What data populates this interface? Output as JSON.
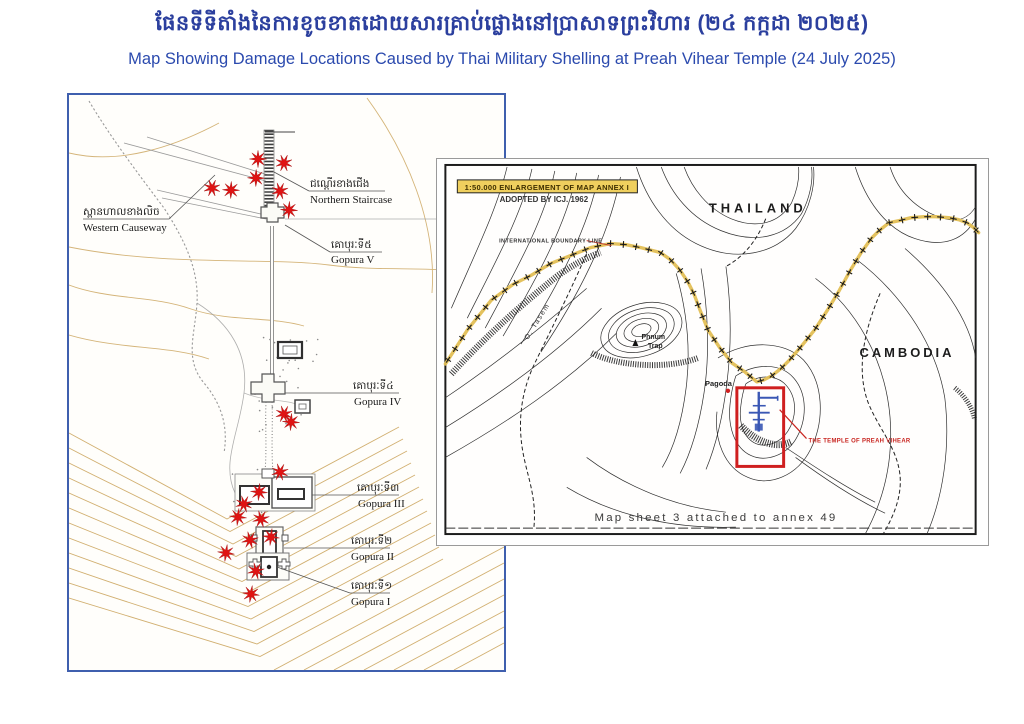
{
  "header": {
    "title_khmer": "ផែនទីទីតាំងនៃការខូចខាតដោយសារគ្រាប់ផ្លោងនៅប្រាសាទព្រះវិហារ (២៤ កក្កដា ២០២៥)",
    "title_english": "Map Showing Damage Locations Caused by Thai Military Shelling at Preah Vihear Temple (24 July 2025)"
  },
  "temple_map": {
    "labels": {
      "western_causeway": {
        "khmer": "ស្ពានហាលខាងលិច",
        "english": "Western Causeway"
      },
      "northern_staircase": {
        "khmer": "ជណ្ដើរខាងជើង",
        "english": "Northern Staircase"
      },
      "gopura_v": {
        "khmer": "គោបុរៈទី៥",
        "english": "Gopura V"
      },
      "gopura_iv": {
        "khmer": "គោបុរៈទី៤",
        "english": "Gopura IV"
      },
      "gopura_iii": {
        "khmer": "គោបុរៈទី៣",
        "english": "Gopura III"
      },
      "gopura_ii": {
        "khmer": "គោបុរៈទី២",
        "english": "Gopura II"
      },
      "gopura_i": {
        "khmer": "គោបុរៈទី១",
        "english": "Gopura I"
      }
    },
    "damage_stars": [
      [
        189,
        64
      ],
      [
        215,
        68
      ],
      [
        187,
        83
      ],
      [
        143,
        93
      ],
      [
        162,
        95
      ],
      [
        211,
        96
      ],
      [
        220,
        115
      ],
      [
        215,
        319
      ],
      [
        222,
        327
      ],
      [
        211,
        377
      ],
      [
        190,
        397
      ],
      [
        175,
        409
      ],
      [
        169,
        422
      ],
      [
        192,
        424
      ],
      [
        202,
        442
      ],
      [
        181,
        445
      ],
      [
        157,
        458
      ],
      [
        187,
        476
      ],
      [
        182,
        499
      ]
    ]
  },
  "inset_map": {
    "scale_title": "1:50.000 ENLARGEMENT OF MAP ANNEX I",
    "adopted_by": "ADOPTED BY ICJ. 1962",
    "boundary_label": "INTERNATIONAL BOUNDARY LINE",
    "country_north": "THAILAND",
    "country_south": "CAMBODIA",
    "hill_label_line1": "Phnum",
    "hill_label_line2": "Trap",
    "pagoda_label": "Pagoda",
    "temple_callout": "THE TEMPLE OF PREAH VIHEAR",
    "stream_label": "O. Tasem",
    "caption": "Map sheet  3  attached to annex 49"
  },
  "colors": {
    "title_blue": "#2b3f9e",
    "subtitle_blue": "#2b4aae",
    "map_border_blue": "#3f5fae",
    "star_red": "#e01313",
    "boundary_yellow": "#e3bf55",
    "annotation_red": "#c8241f",
    "temple_blue": "#3a57b4",
    "contour_tan": "#c69c4e"
  }
}
